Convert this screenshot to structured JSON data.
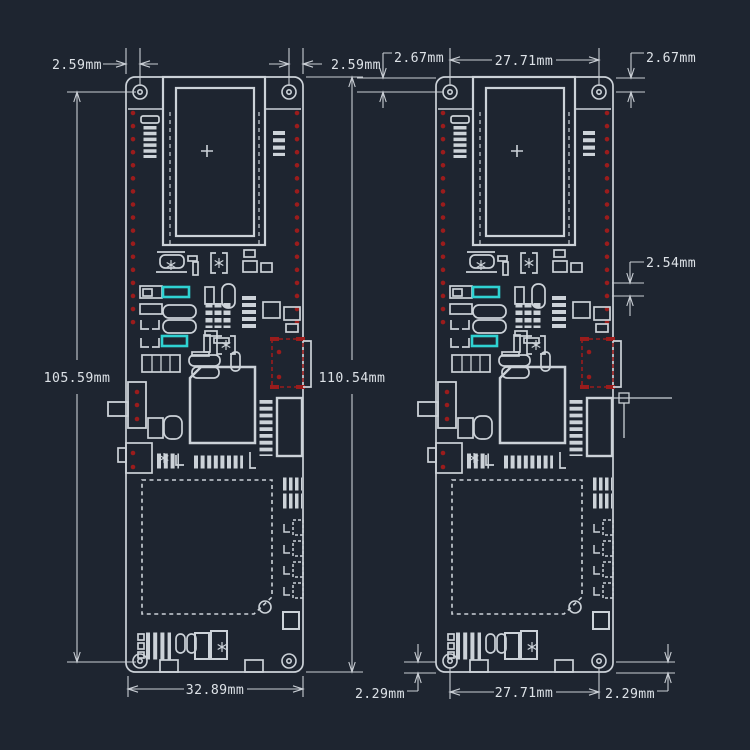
{
  "drawing": {
    "background_color": "#1e2530",
    "line_color": "#ccd2d8",
    "text_color": "#dde2e7",
    "pad_color": "#9b1c1c",
    "highlight_color": "#2fd2d2",
    "views": {
      "left": {
        "dimensions": {
          "hole_offset_left": "2.59mm",
          "hole_offset_right": "2.59mm",
          "hole_span_height": "105.59mm",
          "board_height": "110.54mm",
          "board_width": "32.89mm"
        }
      },
      "right": {
        "dimensions": {
          "hole_offset_top_left": "2.67mm",
          "hole_span_width_top": "27.71mm",
          "hole_offset_top_right": "2.67mm",
          "header_pin_pitch": "2.54mm",
          "hole_offset_bottom_left": "2.29mm",
          "hole_span_width_bottom": "27.71mm",
          "hole_offset_bottom_right": "2.29mm"
        }
      }
    },
    "symbols": {
      "antenna_center": "+"
    }
  }
}
